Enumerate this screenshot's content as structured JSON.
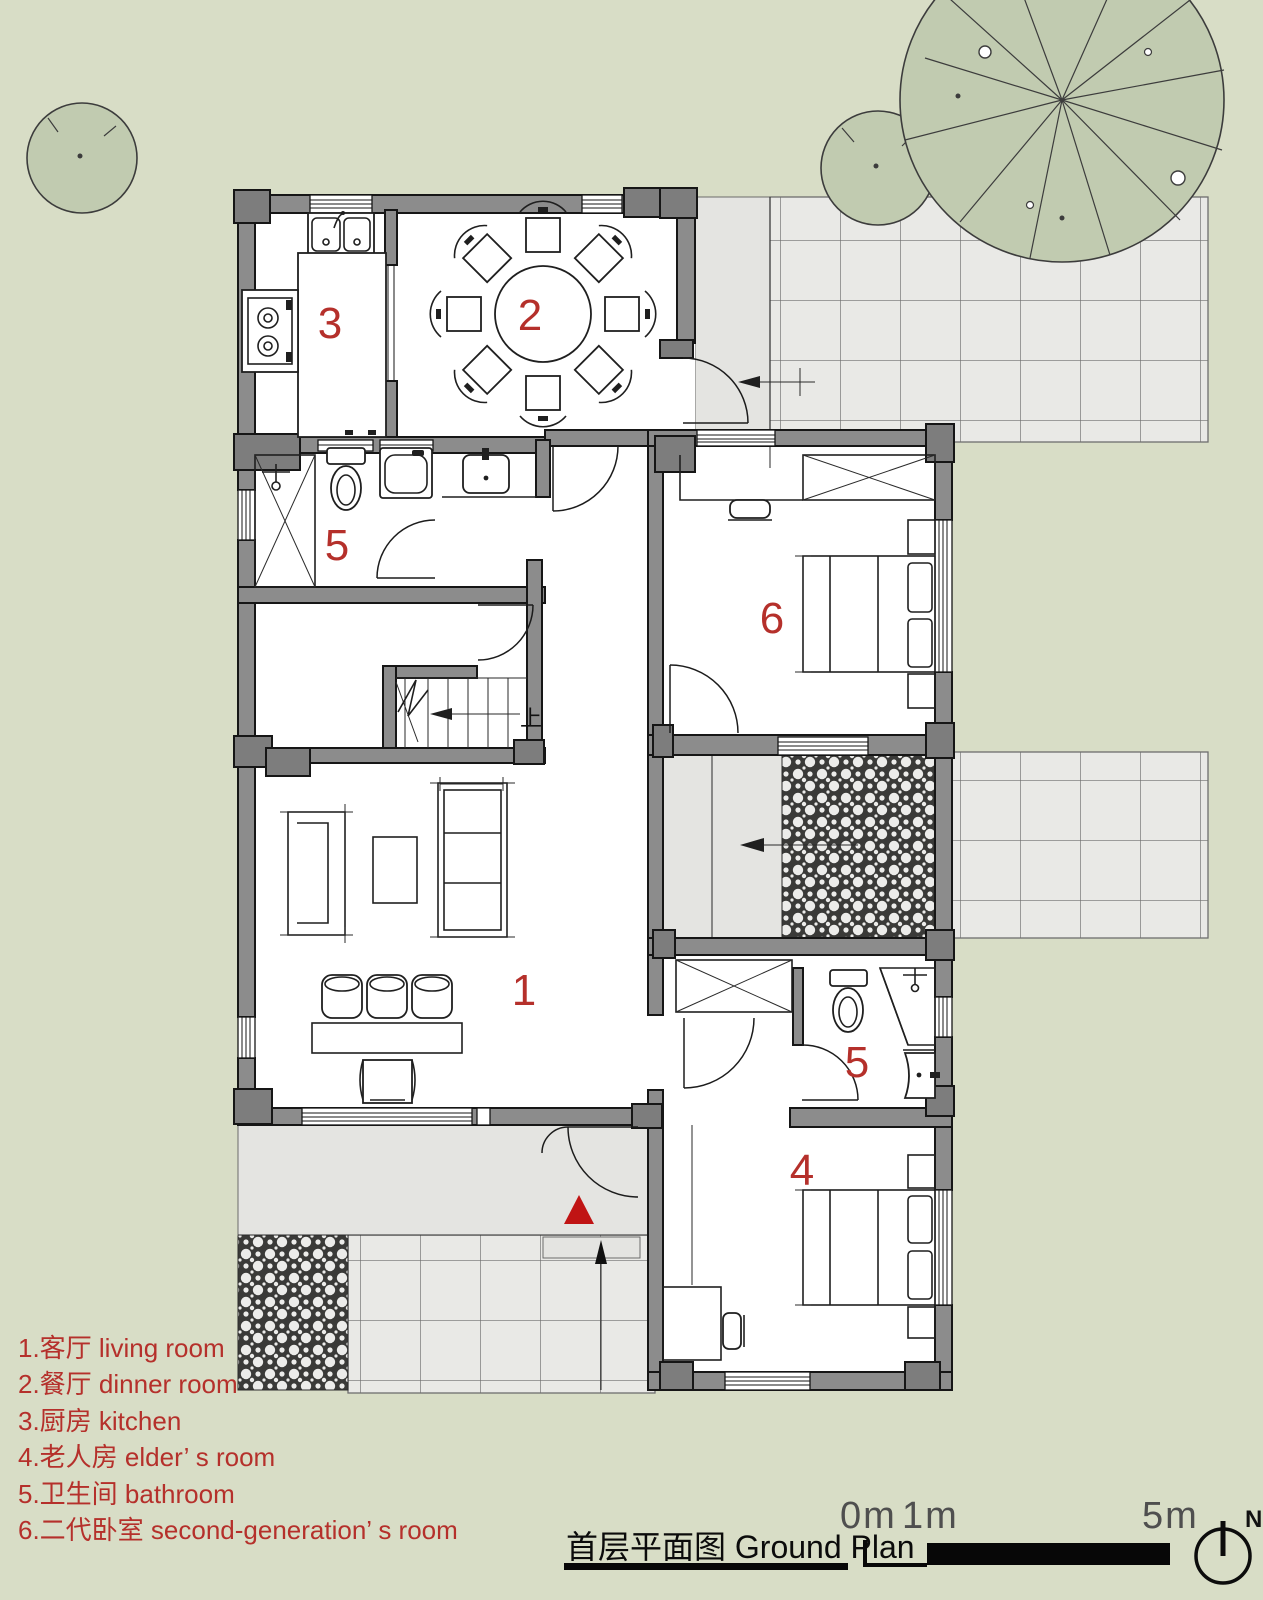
{
  "page": {
    "background": "#d8ddc6"
  },
  "plan": {
    "accent_red": "#b5302b",
    "entrance_marker_color": "#c01414",
    "room_labels": {
      "living": "1",
      "dining": "2",
      "kitchen": "3",
      "elder": "4",
      "bath_upper": "5",
      "bath_lower": "5",
      "second_generation": "6"
    },
    "stairs_up_label": "上"
  },
  "legend": {
    "items": [
      {
        "text": "1.客厅 living room"
      },
      {
        "text": "2.餐厅 dinner room"
      },
      {
        "text": "3.厨房 kitchen"
      },
      {
        "text": "4.老人房 elder’ s room"
      },
      {
        "text": "5.卫生间 bathroom"
      },
      {
        "text": "6.二代卧室 second-generation’ s room"
      }
    ]
  },
  "footer": {
    "title_zh": "首层平面图",
    "title_en": " Ground Plan",
    "scale_labels": {
      "zero": "0m",
      "one": "1m",
      "five": "5m"
    },
    "north_label": "N"
  }
}
